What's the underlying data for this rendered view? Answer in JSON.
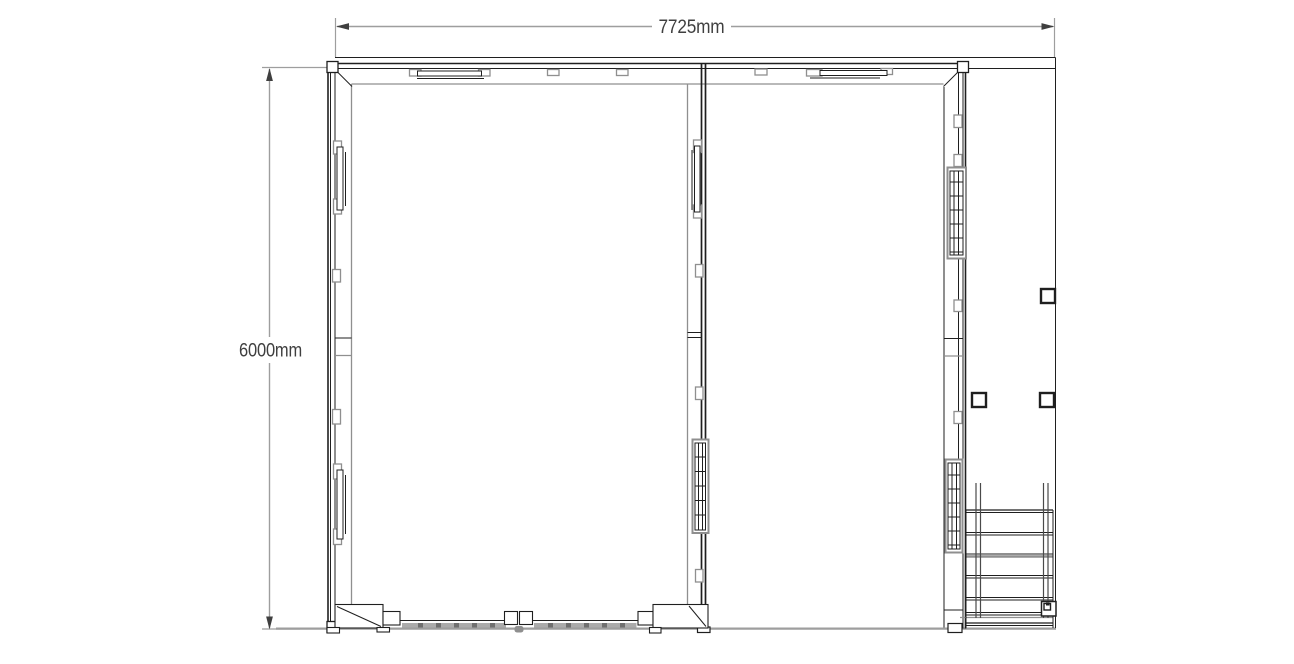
{
  "drawing": {
    "type": "cad-floor-plan",
    "dimensions": {
      "width_label": "7725mm",
      "height_label": "6000mm"
    },
    "colors": {
      "background": "#ffffff",
      "wall_line": "#1f1f1f",
      "interior_line": "#8f8f8f",
      "ground_line": "#9e9e9e",
      "dimension_line": "#9e9e9e",
      "dimension_text": "#3f3f3f",
      "door_track": "#ababab",
      "door_track_dash": "#6f6f6f"
    },
    "components": [
      "left-room",
      "right-room",
      "dividing-wall",
      "side-deck",
      "staircase",
      "sliding-door",
      "wall-window-panels",
      "deck-posts",
      "ground-line"
    ]
  }
}
